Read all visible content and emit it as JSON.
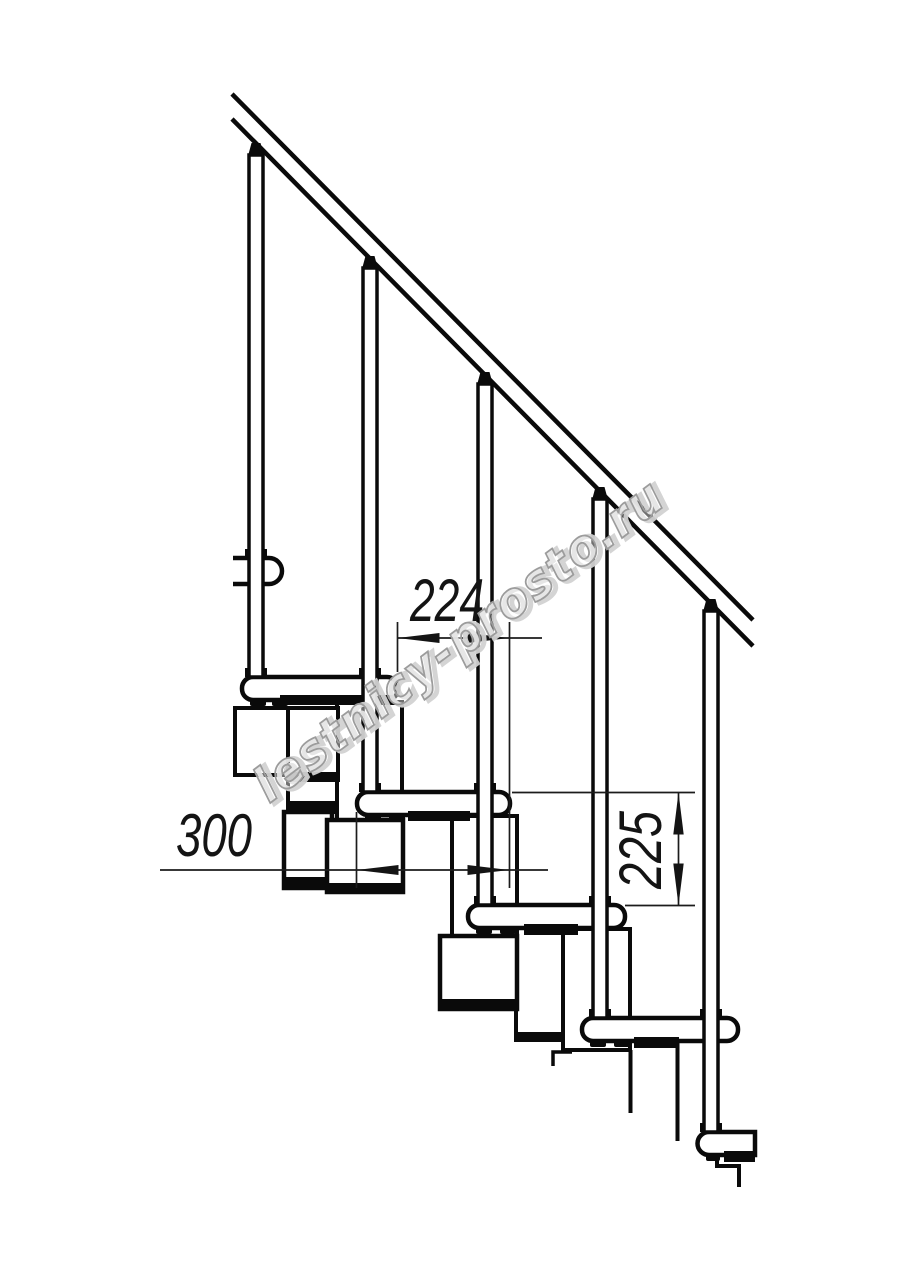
{
  "drawing": {
    "description": "Side elevation of a modular staircase with handrail, balusters, treads and support modules",
    "watermark": "lestnicy-prosto.ru",
    "dimensions": {
      "step_run": "224",
      "tread_depth": "300",
      "step_rise": "225"
    },
    "colors": {
      "line": "#0a0a0a",
      "dimension": "#1a1a1a",
      "watermark_outline": "#b9b9b9",
      "background": "#ffffff"
    }
  }
}
